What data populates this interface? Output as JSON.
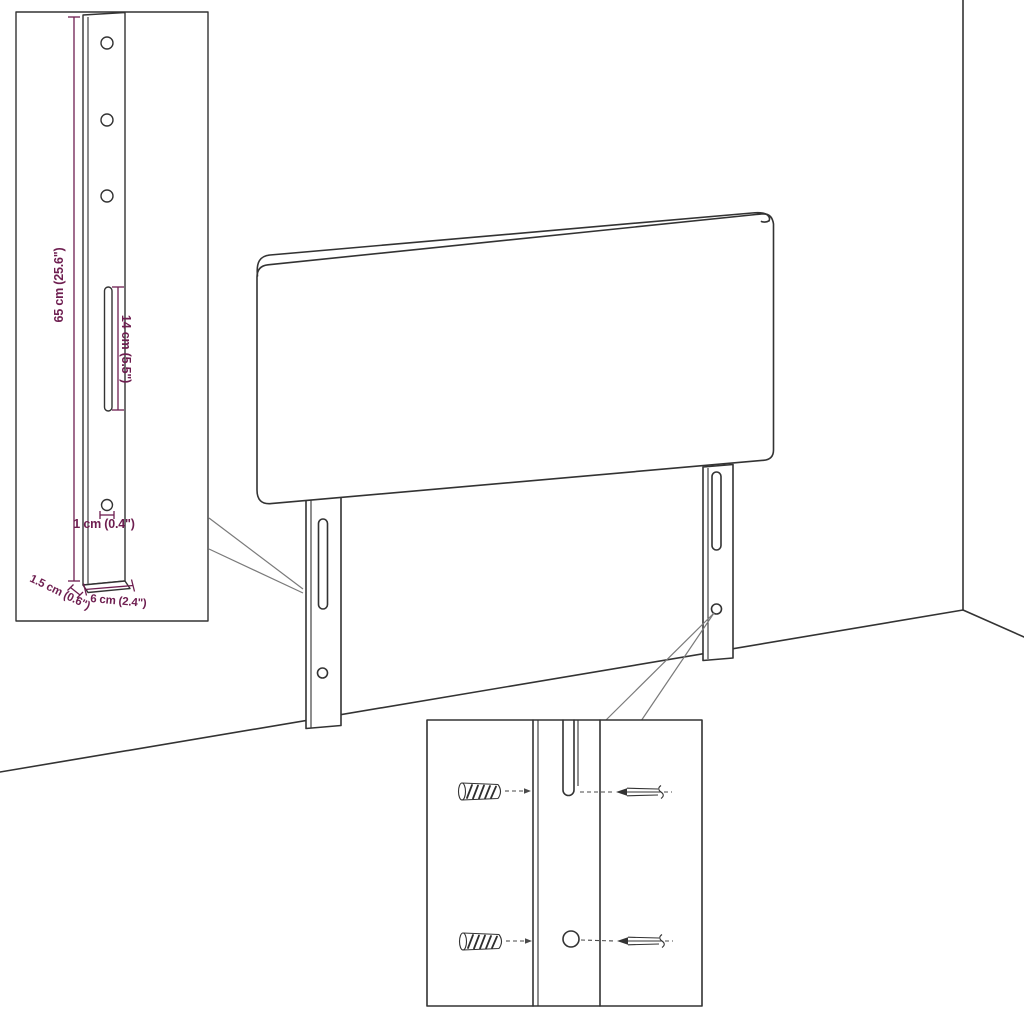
{
  "diagram": {
    "type": "furniture-assembly-dimension-diagram",
    "subject": "upholstered headboard with two mounting legs, wall-corner perspective, bracket dimension inset and wall-fixing hardware inset",
    "background_color": "#ffffff",
    "line_color": "#333333",
    "dimension_color": "#6e1e50",
    "labels": {
      "bracket_height": "65 cm (25.6\")",
      "slot_length": "14 cm (5.5\")",
      "hole_diameter": "1 cm (0.4\")",
      "bracket_thickness": "1.5 cm (0.6\")",
      "bracket_width": "6 cm (2.4\")"
    }
  }
}
